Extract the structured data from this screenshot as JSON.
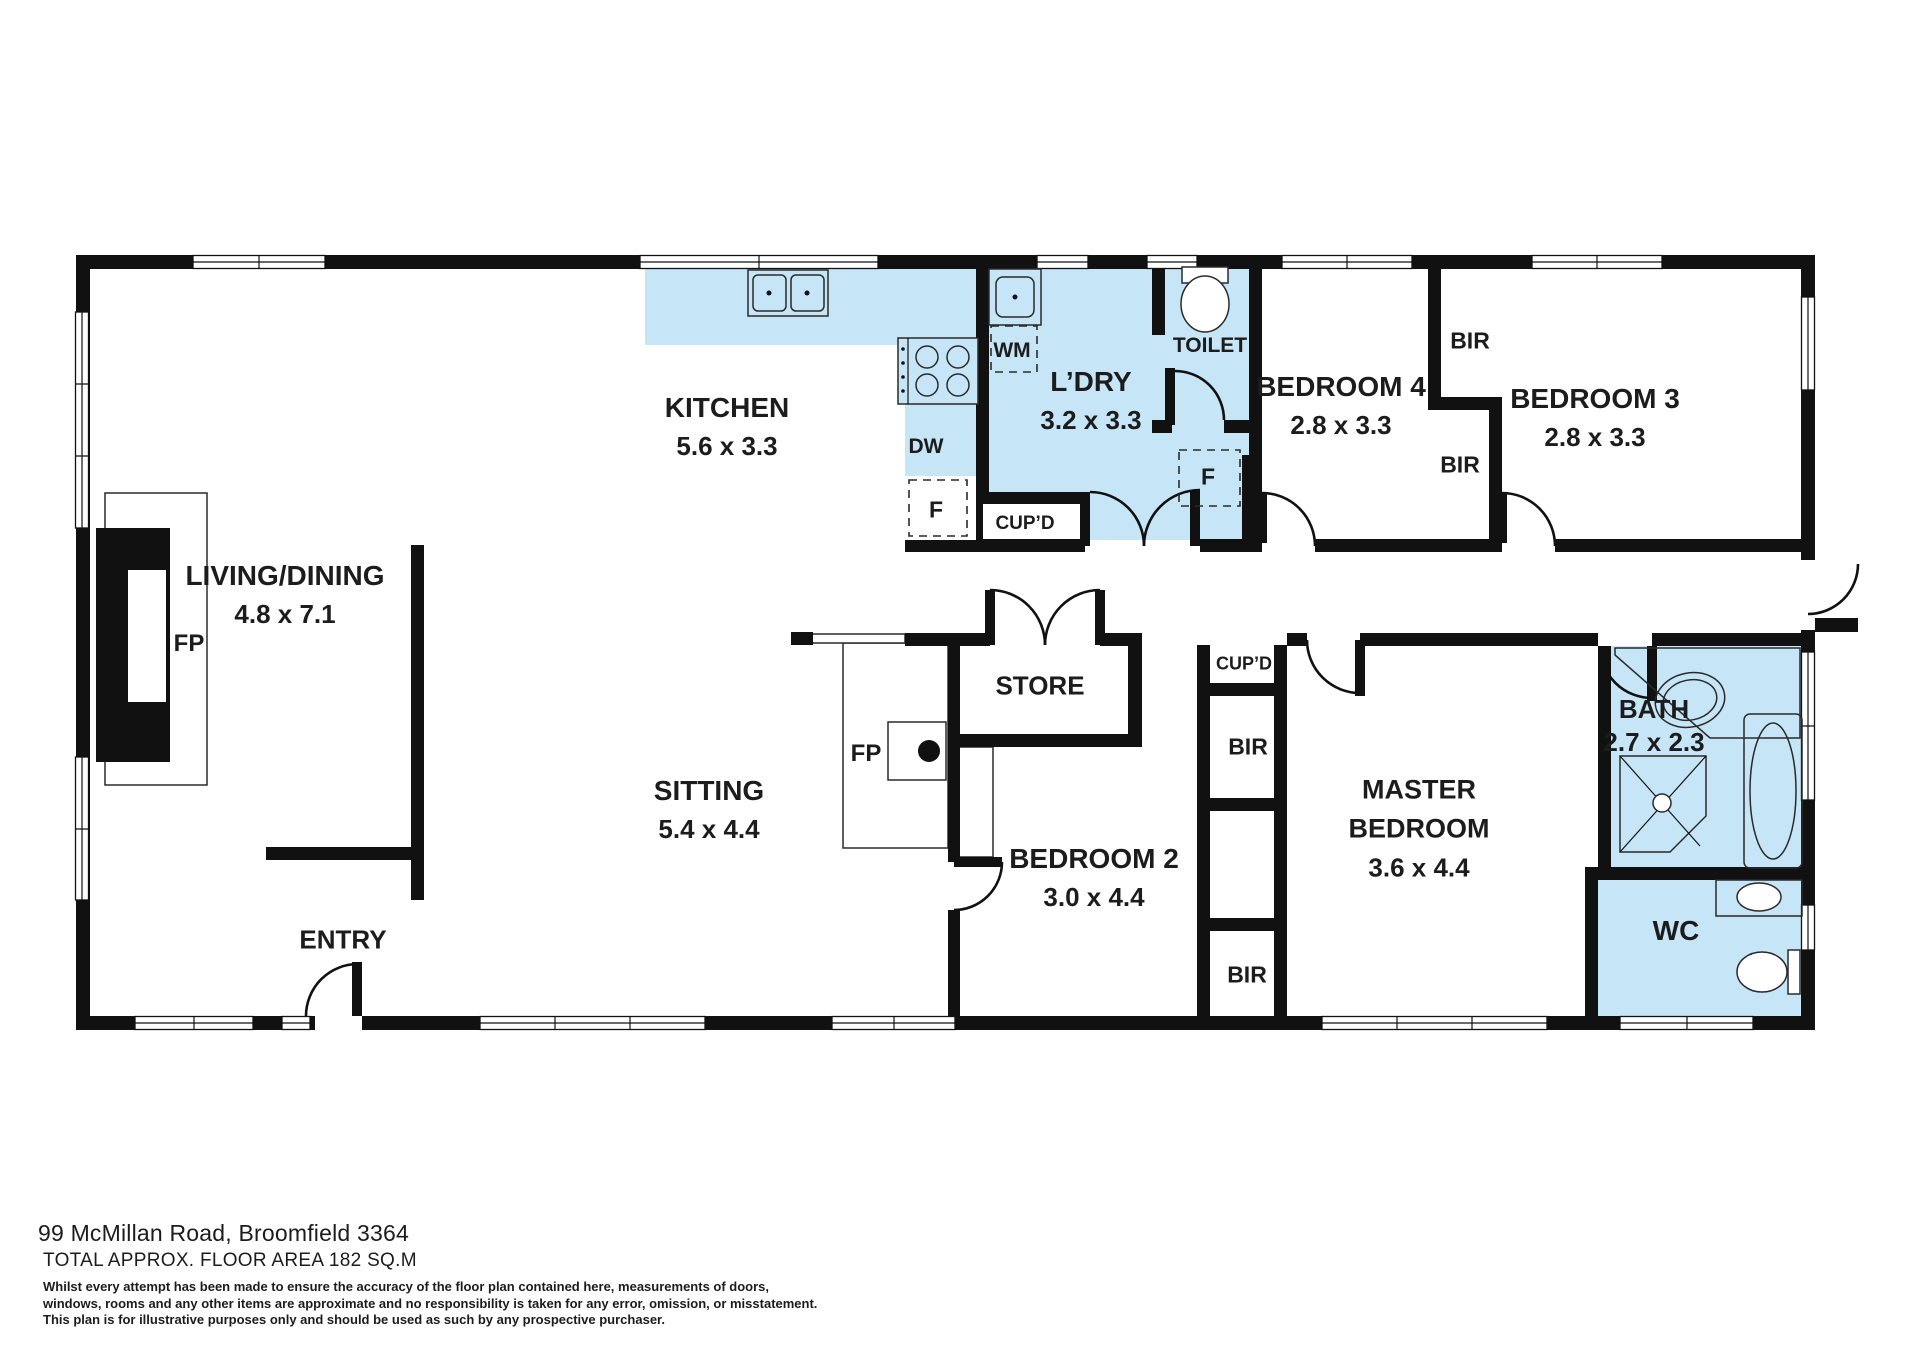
{
  "colors": {
    "room_fill": "#c6e6f7",
    "wall": "#111111"
  },
  "rooms": {
    "living_dining": {
      "name": "LIVING/DINING",
      "dims": "4.8 x 7.1"
    },
    "kitchen": {
      "name": "KITCHEN",
      "dims": "5.6 x 3.3"
    },
    "laundry": {
      "name": "L’DRY",
      "dims": "3.2 x 3.3"
    },
    "toilet": {
      "name": "TOILET"
    },
    "bedroom4": {
      "name": "BEDROOM 4",
      "dims": "2.8 x 3.3"
    },
    "bedroom3": {
      "name": "BEDROOM 3",
      "dims": "2.8 x 3.3"
    },
    "sitting": {
      "name": "SITTING",
      "dims": "5.4 x 4.4"
    },
    "store": {
      "name": "STORE"
    },
    "entry": {
      "name": "ENTRY"
    },
    "bedroom2": {
      "name": "BEDROOM 2",
      "dims": "3.0 x 4.4"
    },
    "master_bedroom": {
      "line1": "MASTER",
      "line2": "BEDROOM",
      "dims": "3.6 x 4.4"
    },
    "bath": {
      "name": "BATH",
      "dims": "2.7 x 2.3"
    },
    "wc": {
      "name": "WC"
    }
  },
  "fixture_labels": {
    "washing_machine": "WM",
    "dishwasher": "DW",
    "fridge": "F",
    "cupboard": "CUP’D",
    "built_in_robe": "BIR",
    "fireplace": "FP"
  },
  "footer": {
    "address": "99 McMillan Road, Broomfield 3364",
    "floor_area": "TOTAL APPROX. FLOOR AREA 182 SQ.M",
    "disclaimer_lines": [
      "Whilst every attempt has been made to ensure the accuracy of the floor plan contained here, measurements of doors,",
      "windows, rooms and any other items are approximate and no responsibility is taken for any error, omission, or misstatement.",
      "This plan is for illustrative purposes only and should be used as such by any prospective purchaser."
    ]
  }
}
